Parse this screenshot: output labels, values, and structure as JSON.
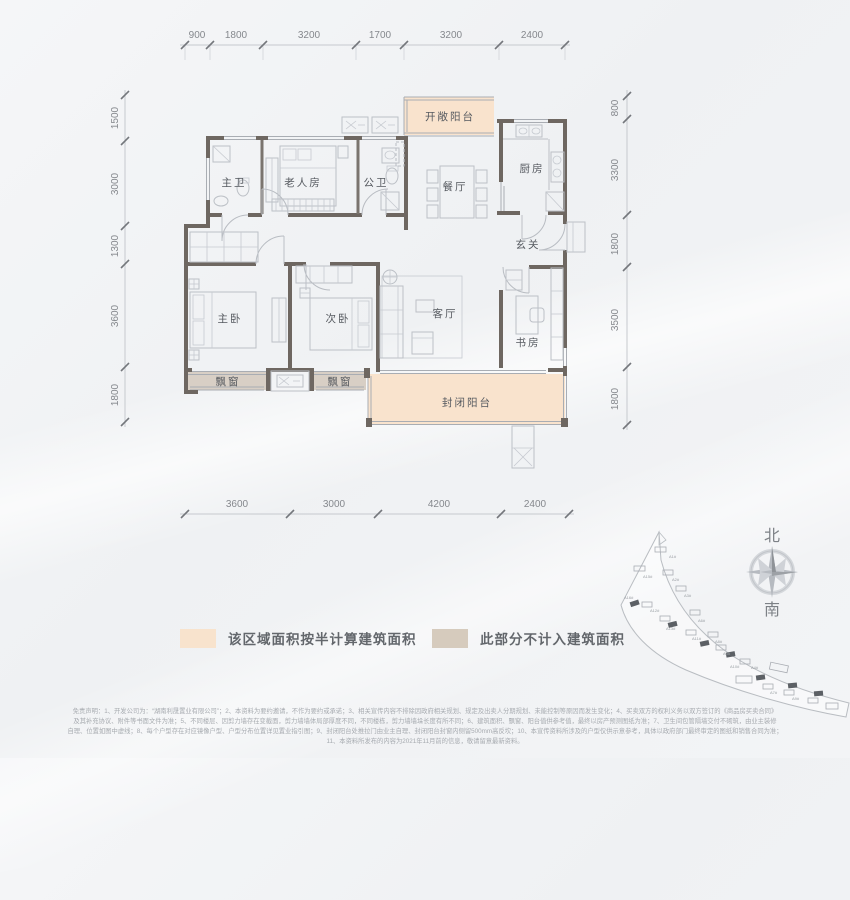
{
  "dims": {
    "top": [
      "900",
      "1800",
      "3200",
      "1700",
      "3200",
      "2400"
    ],
    "left": [
      "1500",
      "3000",
      "1300",
      "3600",
      "1800"
    ],
    "right": [
      "800",
      "3300",
      "1800",
      "3500",
      "1800"
    ],
    "bottom": [
      "3600",
      "3000",
      "4200",
      "2400"
    ]
  },
  "rooms": {
    "master_bath": "主卫",
    "elder_room": "老人房",
    "public_bath": "公卫",
    "dining": "餐厅",
    "kitchen": "厨房",
    "open_balcony": "开敞阳台",
    "foyer": "玄关",
    "master_bedroom": "主卧",
    "second_bedroom": "次卧",
    "living_room": "客厅",
    "study": "书房",
    "bay_window": "飘窗",
    "closed_balcony": "封闭阳台"
  },
  "legend": {
    "half_area": {
      "color": "#f8e3cd",
      "label": "该区域面积按半计算建筑面积"
    },
    "excluded": {
      "color": "#d6cbbd",
      "label": "此部分不计入建筑面积"
    }
  },
  "compass": {
    "north": "北",
    "south": "南"
  },
  "site_plan": {
    "buildings": [
      {
        "label": "A1#"
      },
      {
        "label": "A15#"
      },
      {
        "label": "A2#"
      },
      {
        "label": "A16#"
      },
      {
        "label": "A3#"
      },
      {
        "label": "A12#"
      },
      {
        "label": "A13#"
      },
      {
        "label": "A6#"
      },
      {
        "label": "A11#"
      },
      {
        "label": "A8#"
      },
      {
        "label": "A5#"
      },
      {
        "label": "A10#"
      },
      {
        "label": "A4#"
      },
      {
        "label": "A7#"
      },
      {
        "label": "A9#"
      }
    ]
  },
  "disclaimer": {
    "line1": "免责声明：1、开发公司为：“湖南利晟置业有限公司”；2、本资料为要约邀请，不作为要约或承诺；3、相关宣传内容不排除因政府相关规划、规定及出卖人分期规划、未能控制等原因而发生变化；4、买卖双方的权利义务以双方签订的《商品房买卖合同》",
    "line2": "及其补充协议、附件等书面文件为准；5、不同楼层、因剪力墙存在变截面，剪力墙墙体局部厚度不同，不同楼栋，剪力墙墙垛长度有所不同；6、建筑面积、飘窗、阳台值供参考值，最终以房产预测图纸为准；7、卫生间包管隔墙交付不砌筑，由业主装修",
    "line3": "自理、位置如图中虚线；8、每个户型存在对应镜像户型、户型分布位置详见置业指引图；9、封闭阳台处推拉门由业主自理、封闭阳台封窗内侧留500mm高反坎；10、本宣传资料所涉及的户型仅供示意参考，具体以政府部门最终审定的图纸和销售合同为准；",
    "line4": "11、本资料所发布的内容为2021年11月前的信息，敬请留意最新资料。"
  },
  "colors": {
    "wall": "#6e6761",
    "half_area_fill": "#f9e3cd",
    "excluded_fill": "#d8cfc5"
  }
}
